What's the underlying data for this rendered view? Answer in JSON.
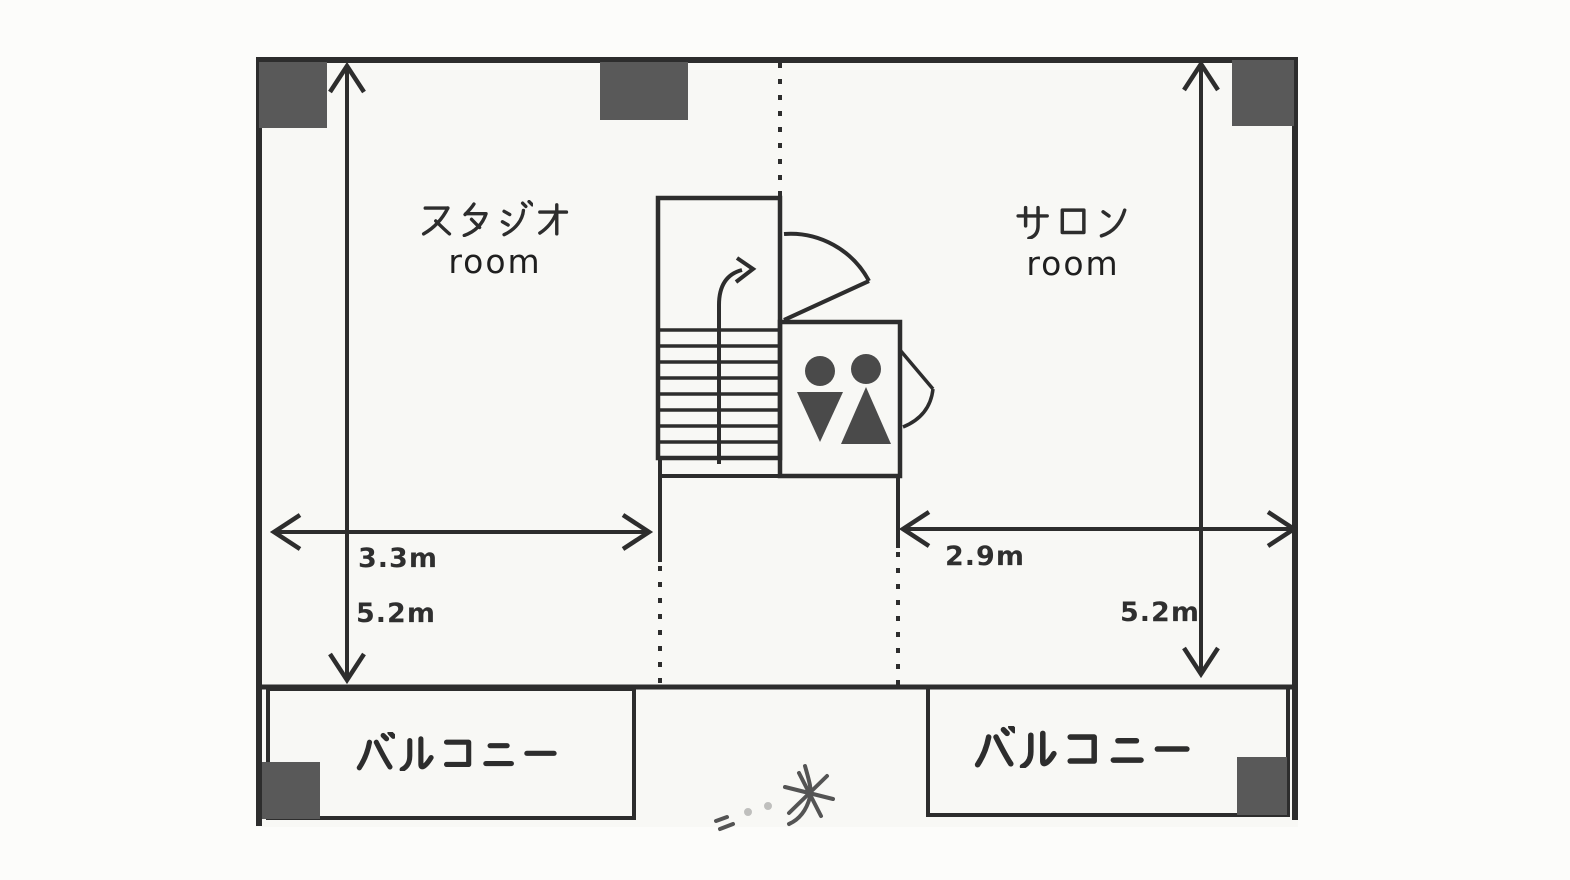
{
  "plan": {
    "type": "floor-plan",
    "rooms": {
      "studio": {
        "name_jp": "スタジオ",
        "name_en": "room"
      },
      "salon": {
        "name_jp": "サロン",
        "name_en": "room"
      }
    },
    "balconies": {
      "left": {
        "label_jp": "バルコニー"
      },
      "right": {
        "label_jp": "バルコニー"
      }
    },
    "dimensions": {
      "studio_width": "3.3m",
      "studio_depth": "5.2m",
      "salon_width": "2.9m",
      "salon_depth": "5.2m"
    },
    "features": {
      "stairs": "stairs-with-up-arrow",
      "toilet_icons": [
        "male-figure-icon",
        "female-figure-icon"
      ],
      "doors": [
        "door-swing-arc-large",
        "door-swing-arc-small"
      ]
    },
    "colors": {
      "line": "#2d2d2d",
      "pillar": "#595959",
      "icon_fill": "#4a4a4a",
      "paper": "#f8f8f5"
    }
  }
}
